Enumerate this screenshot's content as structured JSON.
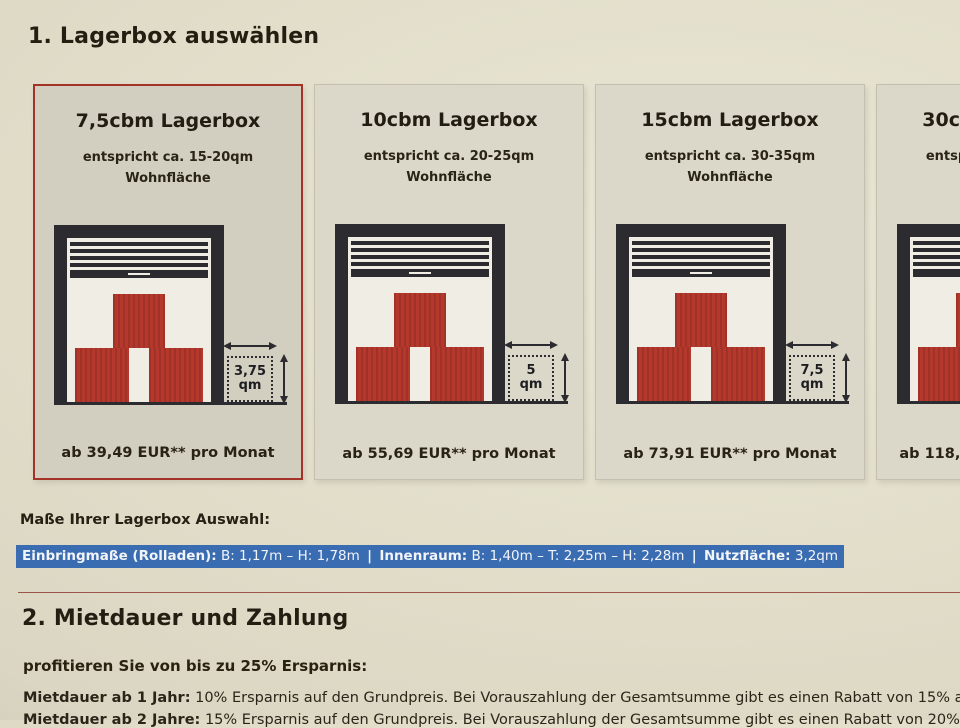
{
  "section1": {
    "title": "1. Lagerbox auswählen"
  },
  "cards": [
    {
      "title": "7,5cbm Lagerbox",
      "subtitle_line1": "entspricht ca. 15-20qm",
      "subtitle_line2": "Wohnfläche",
      "qm_value": "3,75",
      "qm_unit": "qm",
      "price": "ab 39,49 EUR** pro Monat",
      "selected": true
    },
    {
      "title": "10cbm Lagerbox",
      "subtitle_line1": "entspricht ca. 20-25qm",
      "subtitle_line2": "Wohnfläche",
      "qm_value": "5",
      "qm_unit": "qm",
      "price": "ab 55,69 EUR** pro Monat",
      "selected": false
    },
    {
      "title": "15cbm Lagerbox",
      "subtitle_line1": "entspricht ca. 30-35qm",
      "subtitle_line2": "Wohnfläche",
      "qm_value": "7,5",
      "qm_unit": "qm",
      "price": "ab 73,91 EUR** pro Monat",
      "selected": false
    },
    {
      "title": "30cbm Lagerbox",
      "subtitle_line1": "entspricht ca. 60-70qm",
      "subtitle_line2": "Wohnfläche",
      "qm_value": "15",
      "qm_unit": "qm",
      "price": "ab 118,46 EUR** pro Monat",
      "selected": false
    }
  ],
  "measures": {
    "label": "Maße Ihrer Lagerbox Auswahl:",
    "separator": "|",
    "segments": [
      {
        "label": "Einbringmaße (Rolladen):",
        "value": "B: 1,17m – H: 1,78m"
      },
      {
        "label": "Innenraum:",
        "value": "B: 1,40m – T: 2,25m – H: 2,28m"
      },
      {
        "label": "Nutzfläche:",
        "value": "3,2qm"
      }
    ]
  },
  "section2": {
    "title": "2. Mietdauer und Zahlung",
    "intro": "profitieren Sie von bis zu 25% Ersparnis:",
    "line1_label": "Mietdauer ab 1 Jahr:",
    "line1_text": "10% Ersparnis auf den Grundpreis. Bei Vorauszahlung der Gesamtsumme gibt es einen Rabatt von 15% auf den Grundpreis.",
    "line2_label": "Mietdauer ab 2 Jahre:",
    "line2_text": "15% Ersparnis auf den Grundpreis. Bei Vorauszahlung der Gesamtsumme gibt es einen Rabatt von 20% auf den Grundpreis."
  },
  "colors": {
    "accent_red": "#a33227",
    "box_red": "#b4382c",
    "highlight_blue": "#3a6cb2",
    "frame_dark": "#2c2b30"
  }
}
